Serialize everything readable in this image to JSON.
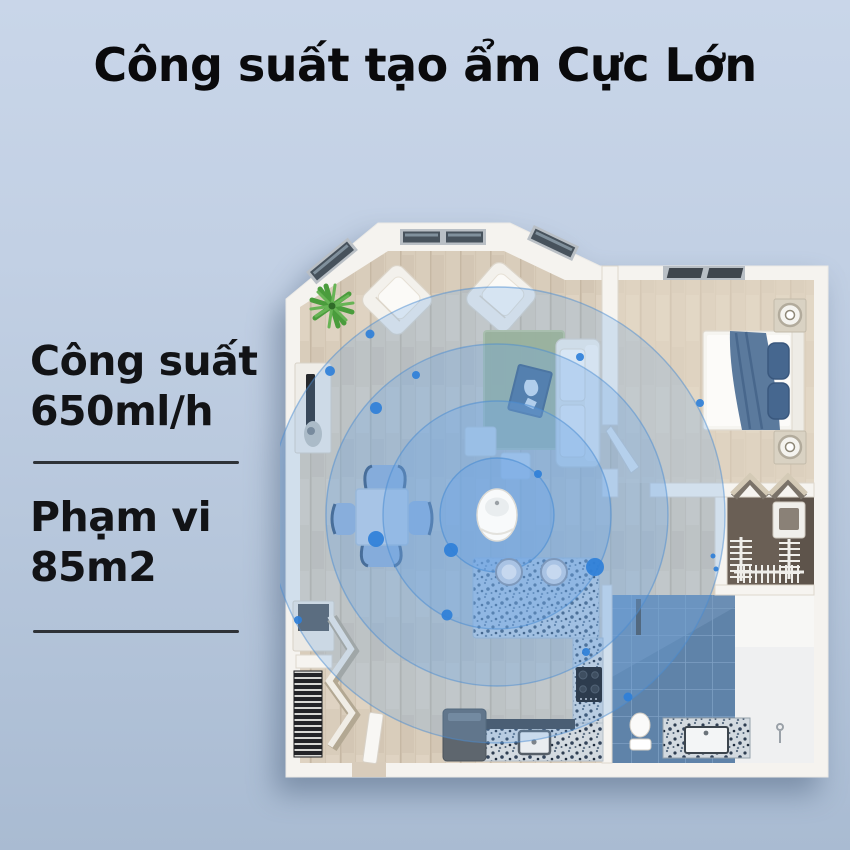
{
  "title": "Công suất tạo ẩm Cực Lớn",
  "specs": {
    "capacity": {
      "label": "Công suất",
      "value": "650ml/h"
    },
    "coverage": {
      "label": "Phạm vi",
      "value": "85m2"
    }
  },
  "floorplan": {
    "type": "apartment-top-view",
    "device": "humidifier",
    "mist_rings": 4,
    "rooms": [
      "living-room",
      "bedroom",
      "walk-in-closet",
      "bathroom",
      "kitchen",
      "entry-nook"
    ]
  },
  "colors": {
    "background_top": "#c9d6e9",
    "background_bottom": "#a9bbd2",
    "title_text": "#0a0a0c",
    "spec_text": "#121316",
    "underline": "#2e3237",
    "wall": "#f5f3ef",
    "wood_floor": "#d9cdbb",
    "bedroom_floor": "#e4d9c7",
    "tile_floor": "#5f83a9",
    "closet_floor": "#6a5f55",
    "granite": "#d3dae0",
    "rug": "#a9b585",
    "bedding": "#5b7a9d",
    "ripple_fill": "#6ea6e4",
    "ripple_stroke": "#4a8cd2",
    "ripple_dot": "#2f80d9"
  }
}
